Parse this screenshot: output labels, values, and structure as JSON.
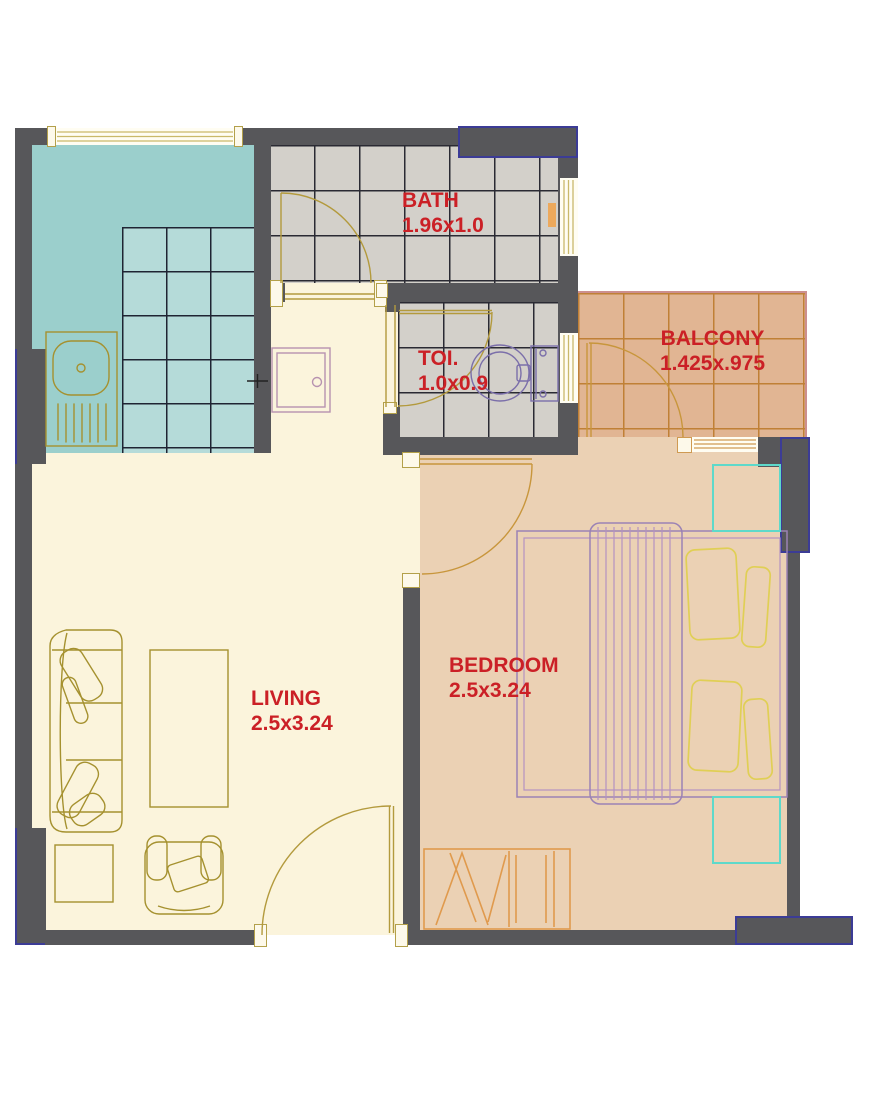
{
  "plan": {
    "rooms": {
      "bath": {
        "label": "BATH",
        "dims": "1.96x1.0"
      },
      "toilet": {
        "label": "TOI.",
        "dims": "1.0x0.9"
      },
      "balcony": {
        "label": "BALCONY",
        "dims": "1.425x.975"
      },
      "living": {
        "label": "LIVING",
        "dims": "2.5x3.24"
      },
      "bedroom": {
        "label": "BEDROOM",
        "dims": "2.5x3.24"
      }
    },
    "symbols": [
      "kitchen-sink",
      "washbasin",
      "toilet",
      "double-bed",
      "pillows",
      "wardrobe",
      "closet",
      "sofa",
      "coffee-table",
      "side-table",
      "armchair",
      "door-swing",
      "window"
    ]
  },
  "colors": {
    "wall": "#57575a",
    "navy": "#3c3c96",
    "label-red": "#cb2026",
    "kitchen": "#9bcfcc",
    "kitchen-tile": "#b5dbd9",
    "tile-gray": "#d3d0ca",
    "living": "#fbf4dc",
    "bedroom": "#ebd1b4",
    "balcony": "#e1b593",
    "furniture-olive": "#a5912f",
    "bed-purple": "#9b82b5",
    "pillow-yellow": "#e0cf55",
    "closet-cyan": "#5ed9ca",
    "wardrobe-orange": "#e09a4d",
    "window-frame": "#c9b96a",
    "fixture-purple": "#7b6faa"
  }
}
